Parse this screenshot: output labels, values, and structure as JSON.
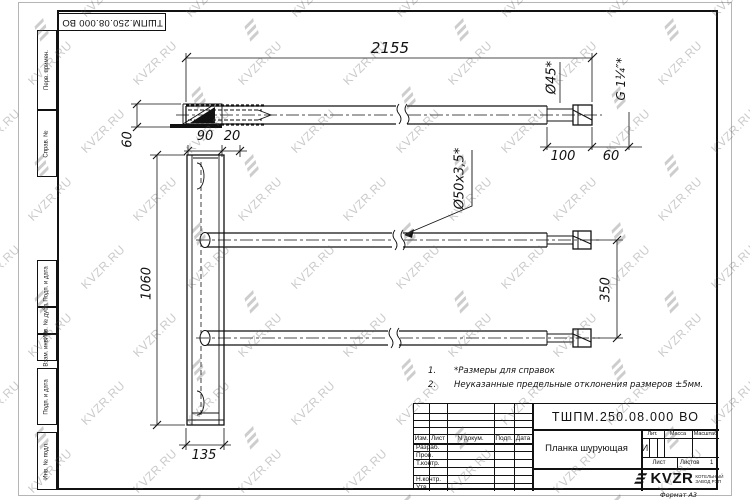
{
  "watermark": {
    "text": "KVZR.RU",
    "color": "#b9b9b9"
  },
  "stamp_top": {
    "doc_number": "ТШПМ.250.08.000 ВО"
  },
  "side_strip": {
    "labels": [
      "Перв. примен.",
      "Справ. №",
      "Подп. и дата",
      "Инв. № дубл.",
      "Взам. инв. №",
      "Подп. и дата",
      "Инв. № подл."
    ]
  },
  "drawing": {
    "dims": {
      "top_length": "2155",
      "dia_end": "Ø45*",
      "thread": "G 1¼″*",
      "height_60": "60",
      "width_90": "90",
      "width_20": "20",
      "len_100": "100",
      "len_60": "60",
      "tube_spec": "Ø50х3,5*",
      "height_1060": "1060",
      "spacing_350": "350",
      "width_135": "135"
    },
    "notes": [
      {
        "num": "1.",
        "text": "*Размеры для справок"
      },
      {
        "num": "2.",
        "text": "Неуказанные предельные отклонения размеров ±5мм."
      }
    ]
  },
  "title_block": {
    "doc_number": "ТШПМ.250.08.000 ВО",
    "part_name": "Планка шурующая",
    "columns": [
      "Изм.",
      "Лист",
      "N докум.",
      "Подп.",
      "Дата"
    ],
    "rows": [
      "Разраб.",
      "Пров.",
      "Т.контр.",
      "Н.контр.",
      "Утв."
    ],
    "lit_label": "Лит.",
    "lit_value": "И",
    "mass_label": "Масса",
    "scale_label": "Масштаб",
    "sheet_label": "Лист",
    "sheets_label": "Листов",
    "sheets_value": "1",
    "logo_text": "KVZR",
    "logo_sub1": "КОТЕЛЬНЫЙ",
    "logo_sub2": "ЗАВОД РЭП",
    "format_label": "Формат А3"
  }
}
